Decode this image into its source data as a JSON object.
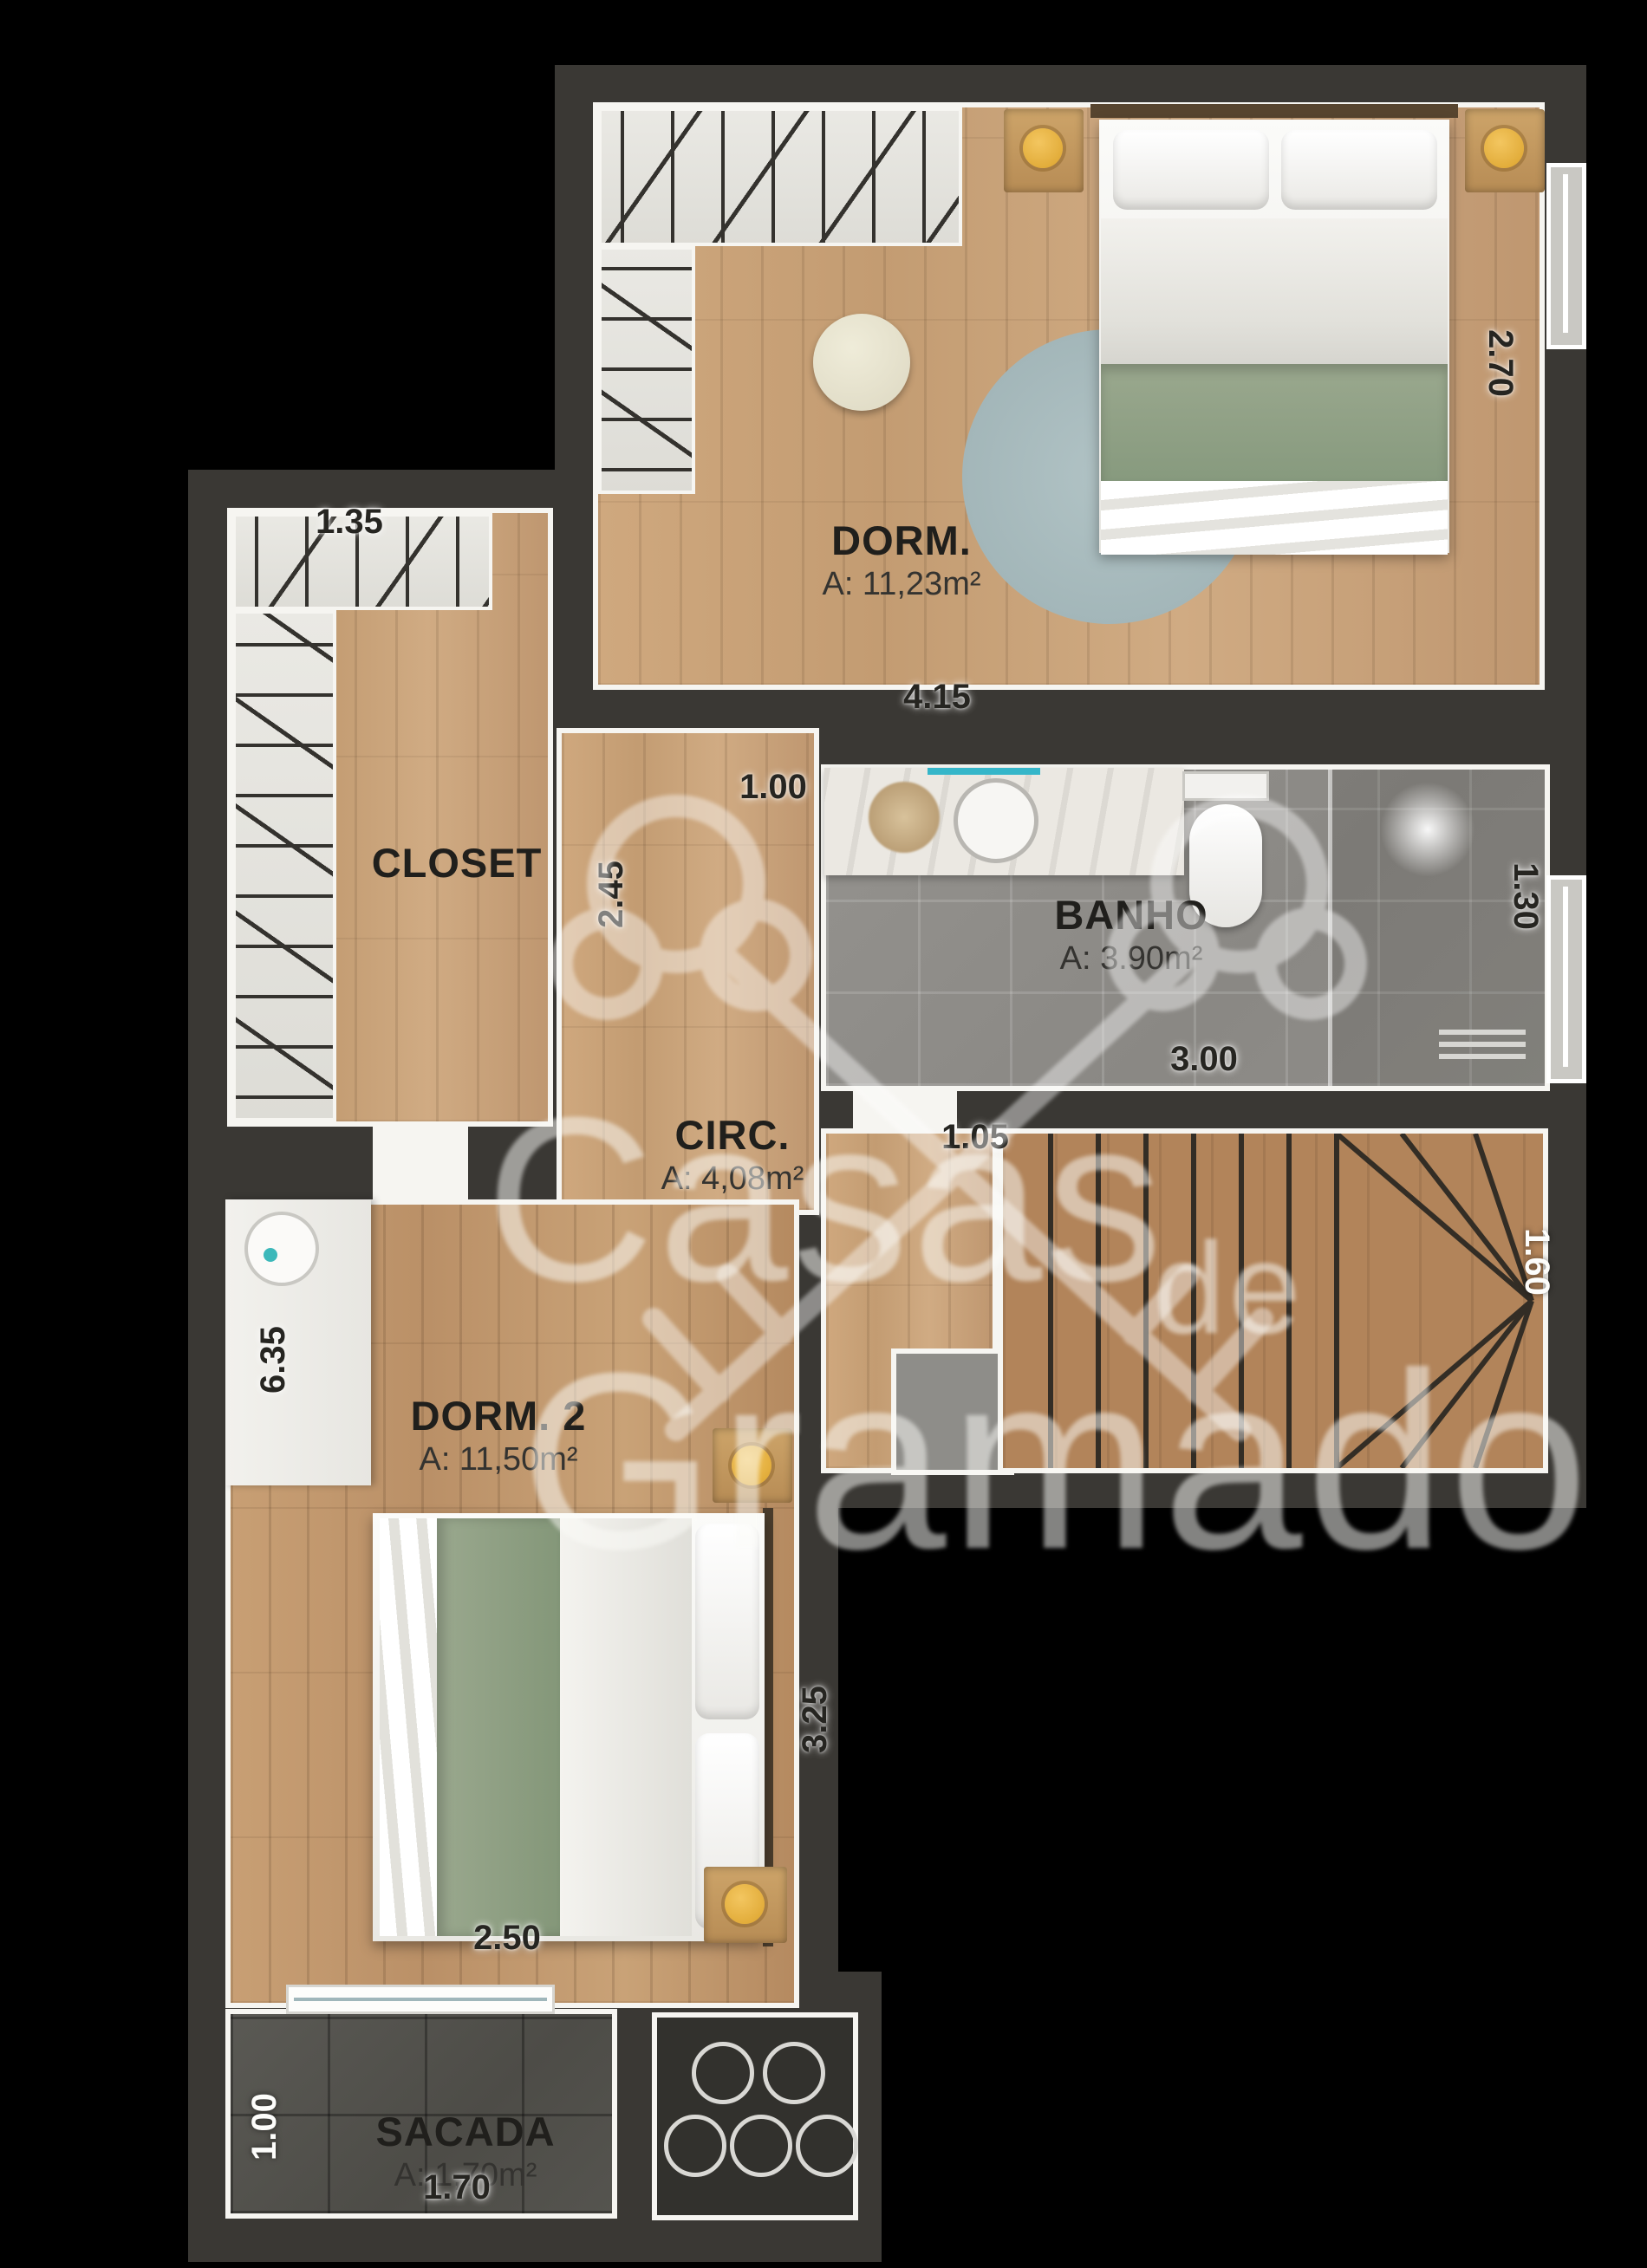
{
  "plan_title": "Floor plan - upper level",
  "rooms": {
    "dorm1": {
      "name": "DORM.",
      "area": "A: 11,23m²"
    },
    "closet": {
      "name": "CLOSET",
      "area": ""
    },
    "banho": {
      "name": "BANHO",
      "area": "A: 3.90m²"
    },
    "circ": {
      "name": "CIRC.",
      "area": "A: 4,08m²"
    },
    "dorm2": {
      "name": "DORM. 2",
      "area": "A: 11,50m²"
    },
    "sacada": {
      "name": "SACADA",
      "area": "A: 1,70m²"
    }
  },
  "dimensions": {
    "closet_width": "1.35",
    "dorm1_depth": "2.70",
    "dorm1_width": "4.15",
    "circ_passage": "1.00",
    "circ_depth": "2.45",
    "banho_depth": "1.30",
    "banho_width": "3.00",
    "circ_width": "1.05",
    "stair_width": "1.60",
    "dorm2_length": "6.35",
    "dorm2_bed_wall": "3.25",
    "dorm2_width": "2.50",
    "sacada_depth": "1.00",
    "sacada_width": "1.70"
  },
  "watermark": {
    "word1": "Casas",
    "word2": "de",
    "word3": "Gramado"
  },
  "colors": {
    "background": "#000000",
    "wall": "#3a3834",
    "trim_white": "#f6f5f1",
    "wood": "#c9a67d",
    "stair_wood": "#b28455",
    "bath_tile": "#8f8d89",
    "balcony_tile": "#54524d",
    "accent_teal": "#35b6c9",
    "lamp_yellow": "#eab33b",
    "blanket_green": "#93a388",
    "rug_blue": "#aabfc2"
  }
}
